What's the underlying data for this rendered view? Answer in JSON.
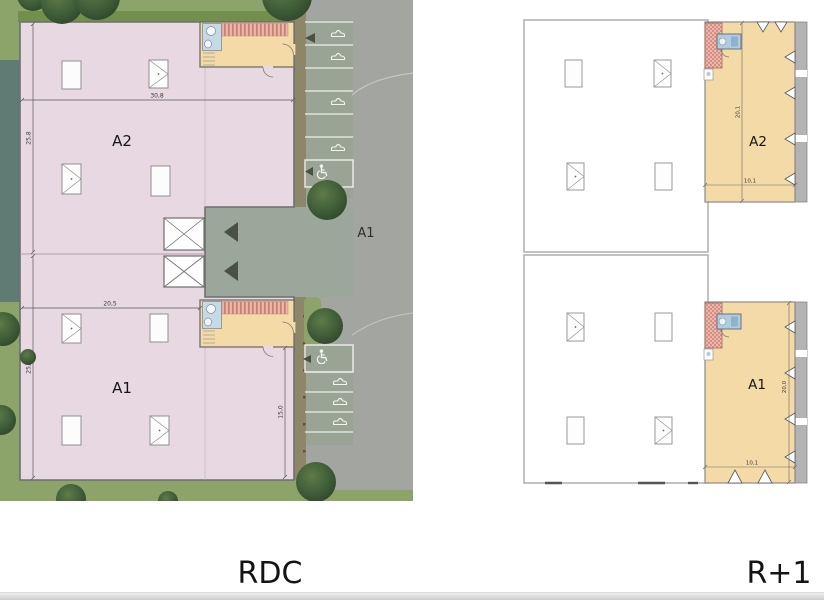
{
  "plans": {
    "rdc": {
      "caption": "RDC",
      "units": {
        "a2": {
          "label": "A2",
          "width_dim": "30,8",
          "depth_dim": "25,8"
        },
        "a1": {
          "label": "A1",
          "width_dim": "20,5",
          "depth_dim": "25,8",
          "wing_dim": "15,0"
        }
      },
      "road_label": "A1"
    },
    "r1": {
      "caption": "R+1",
      "units": {
        "a2": {
          "label": "A2",
          "depth_dim": "20,1",
          "width_dim": "10,1"
        },
        "a1": {
          "label": "A1",
          "depth_dim": "20,0",
          "width_dim": "10,1"
        }
      }
    }
  },
  "icons": {
    "car": "car-outline-glyph",
    "accessible_parking": "wheelchair-symbol",
    "entrance_arrow": "triangle-arrow"
  },
  "colors": {
    "grass": "#8CA369",
    "hedge": "#72904C",
    "water": "#5E7C73",
    "road": "#A2A5A0",
    "parking_asphalt": "#9AA494",
    "apron": "#9AA79A",
    "path_brown": "#8E8668",
    "building_pink": "#E7D8E2",
    "mezzanine_orange": "#F3DAA6",
    "stair_red": "#C97F72",
    "bathroom_blue": "#C6D9E6",
    "tree_green": "#42603A",
    "outline_gray": "#6F6F6F"
  }
}
